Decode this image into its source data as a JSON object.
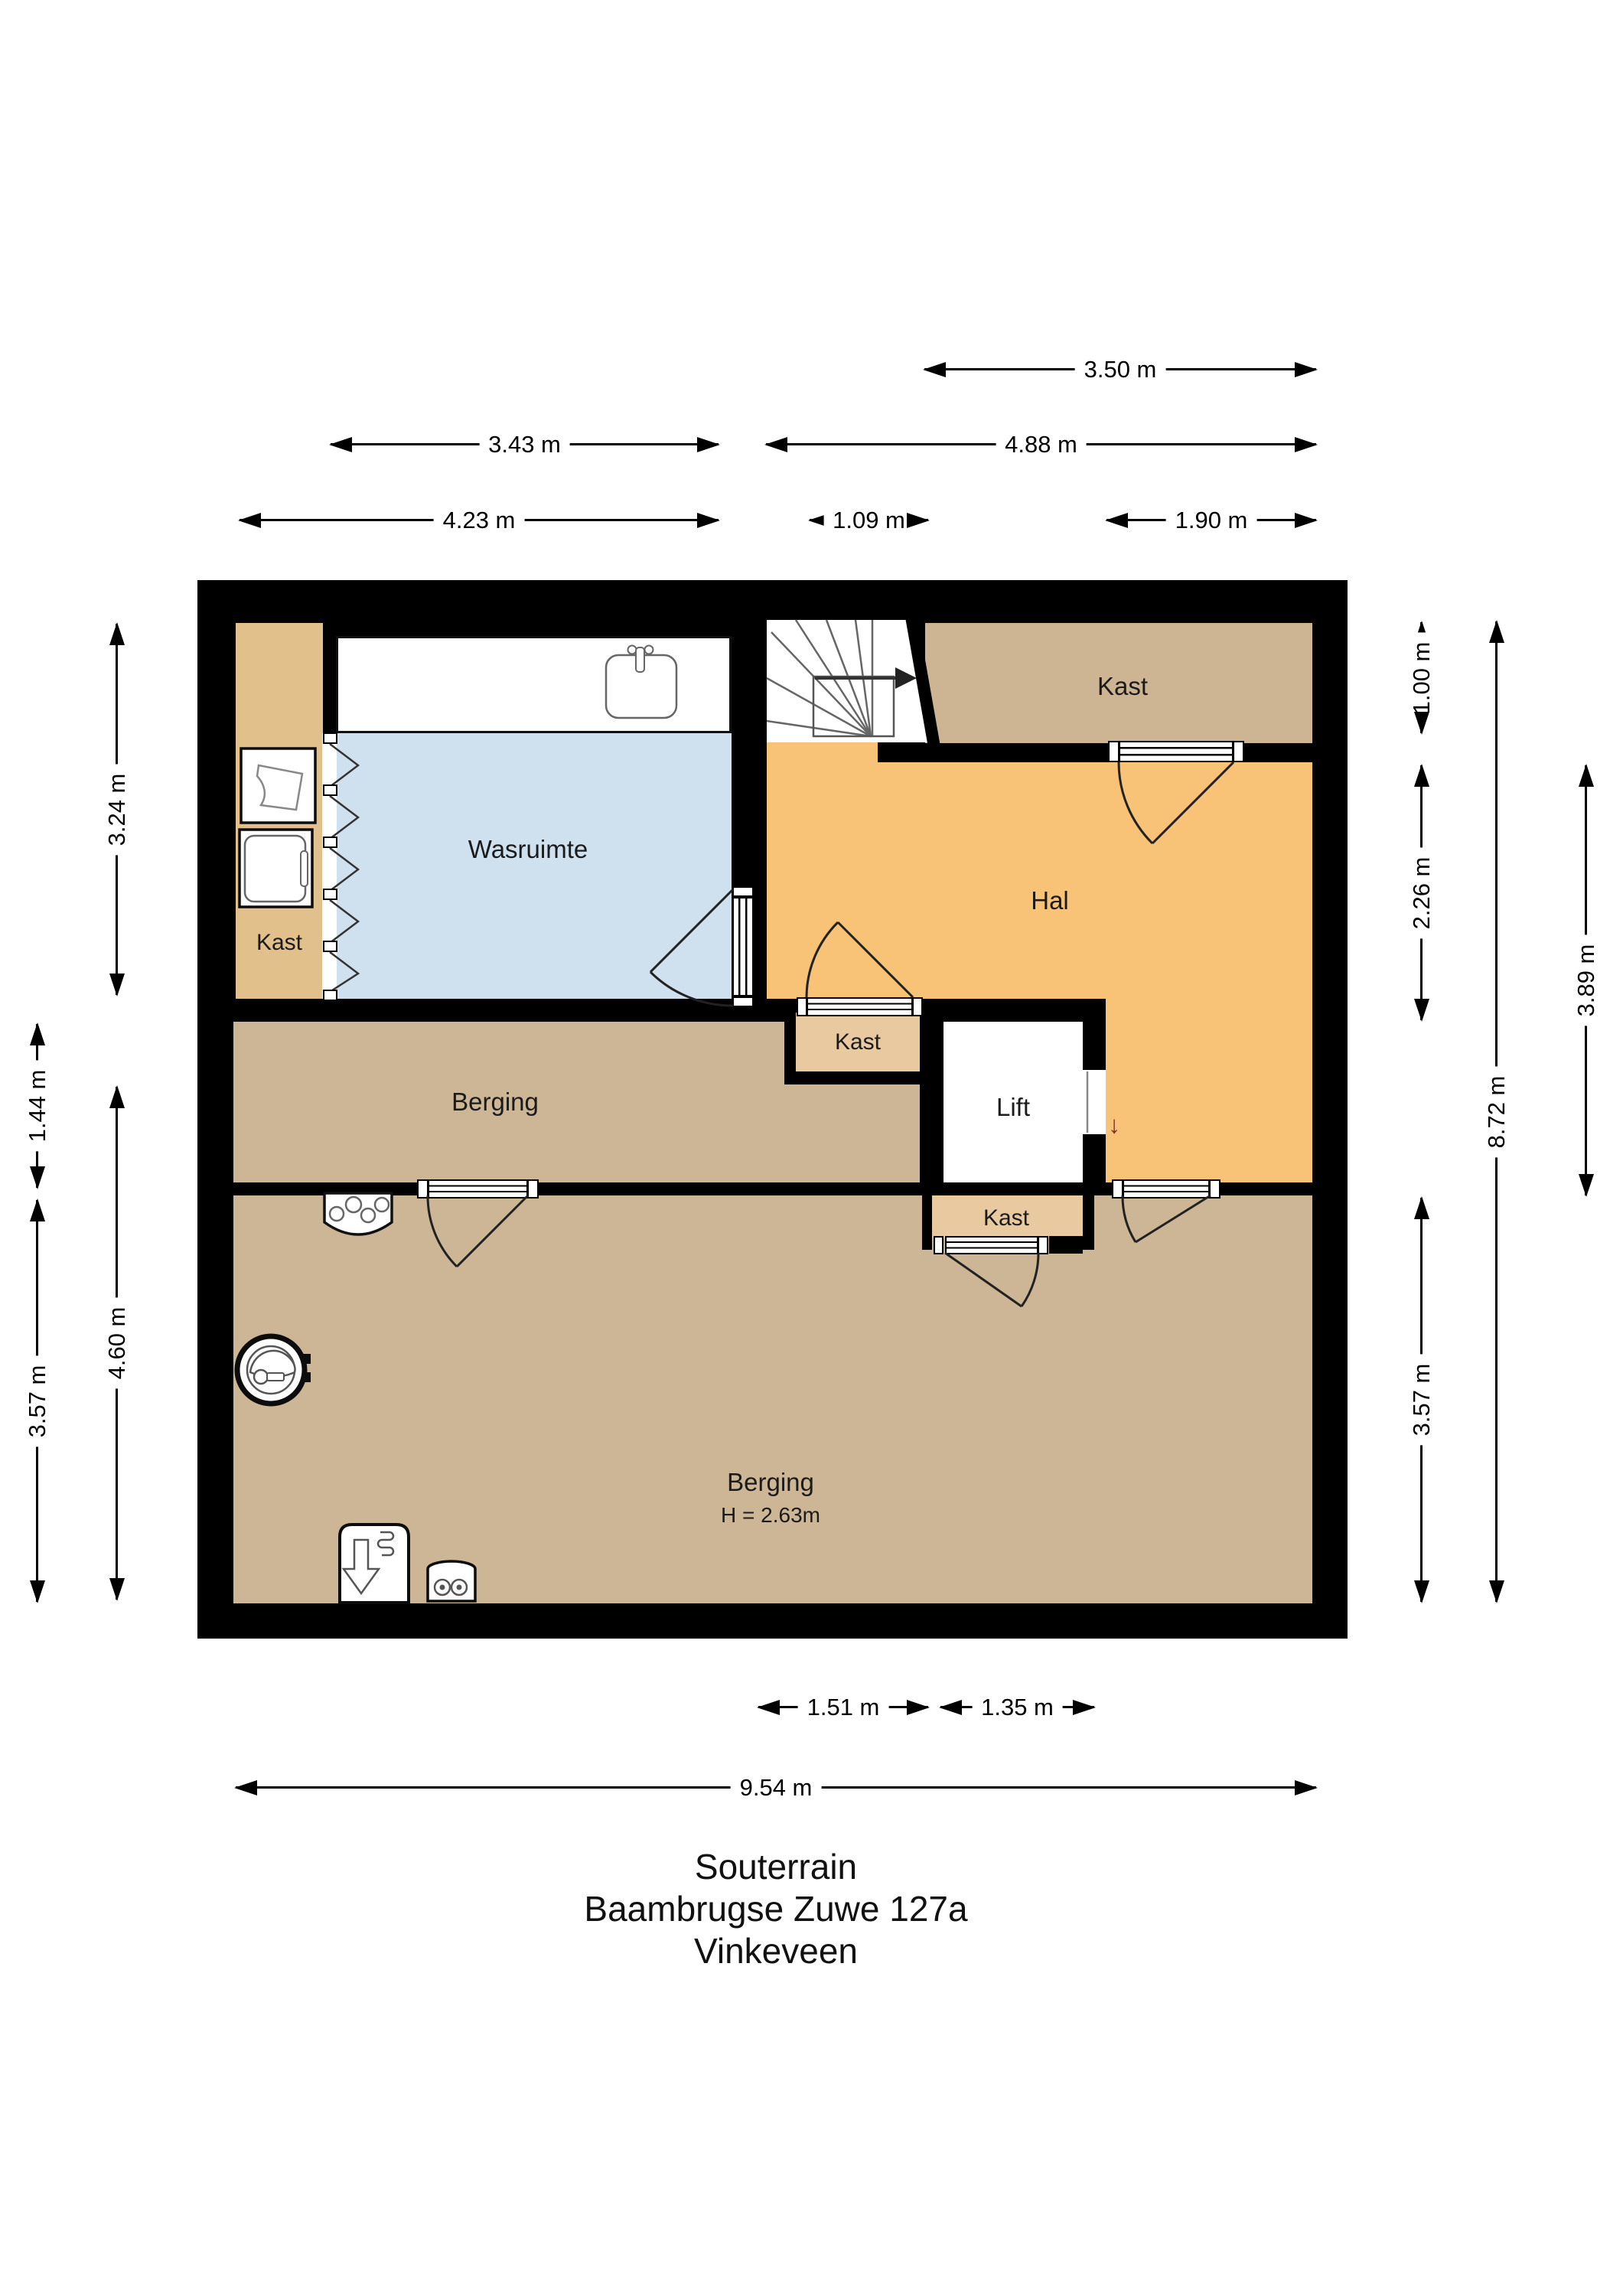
{
  "title": {
    "lines": [
      "Souterrain",
      "Baambrugse Zuwe 127a",
      "Vinkeveen"
    ]
  },
  "rooms": {
    "kast_left": "Kast",
    "wasruimte": "Wasruimte",
    "kast_top_right": "Kast",
    "hal": "Hal",
    "kast_middle": "Kast",
    "lift": "Lift",
    "kast_lower": "Kast",
    "berging_upper": "Berging",
    "berging_lower": "Berging",
    "berging_lower_height": "H = 2.63m",
    "lift_direction_arrow": "↓"
  },
  "dims": {
    "d350": "3.50 m",
    "d343": "3.43 m",
    "d488": "4.88 m",
    "d423": "4.23 m",
    "d109": "1.09 m",
    "d190": "1.90 m",
    "d151": "1.51 m",
    "d135": "1.35 m",
    "d954": "9.54 m",
    "d324": "3.24 m",
    "d144": "1.44 m",
    "d460": "4.60 m",
    "d357_left": "3.57 m",
    "d100": "1.00 m",
    "d226": "2.26 m",
    "d357_right": "3.57 m",
    "d872": "8.72 m",
    "d389": "3.89 m"
  },
  "colors": {
    "wall": "#000000",
    "hal": "#f8c377",
    "wasruimte": "#cfe0ef",
    "kast_column": "#e2c08b",
    "kast_top_right": "#cdb492",
    "kast_small": "#e8c9a0",
    "berging": "#cdb696",
    "lift": "#ffffff",
    "lift_arrow": "#7b2d26"
  }
}
